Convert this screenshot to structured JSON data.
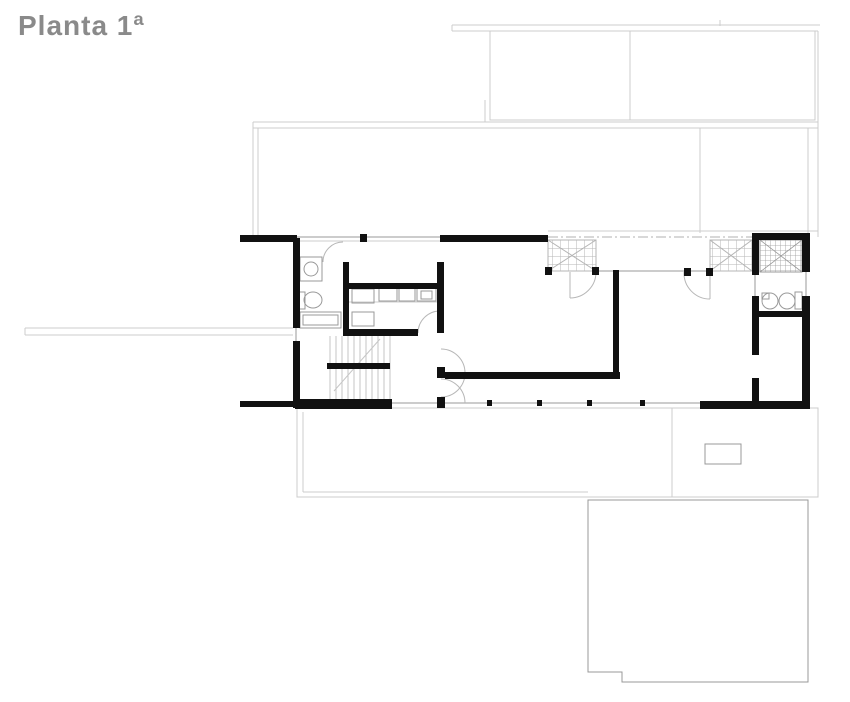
{
  "title": {
    "text": "Planta 1ª",
    "color": "#8a8a8a"
  },
  "drawing": {
    "type": "architectural-floor-plan",
    "floor_label": "Planta 1ª",
    "colors": {
      "walls": "#111111",
      "thin_lines": "#999999",
      "light_outline": "#cccccc",
      "hatch": "#b5b5b5",
      "background": "#ffffff"
    },
    "elements": [
      "upper-level-outline",
      "exterior-walls",
      "interior-partitions",
      "window-openings",
      "door-swings",
      "staircase",
      "kitchen-counter",
      "bathroom-left-fixtures",
      "bathroom-right-fixtures",
      "skylight-grating-panels",
      "gallery-columns",
      "footbridge",
      "terrace-outline",
      "pool-outline",
      "planter"
    ]
  }
}
